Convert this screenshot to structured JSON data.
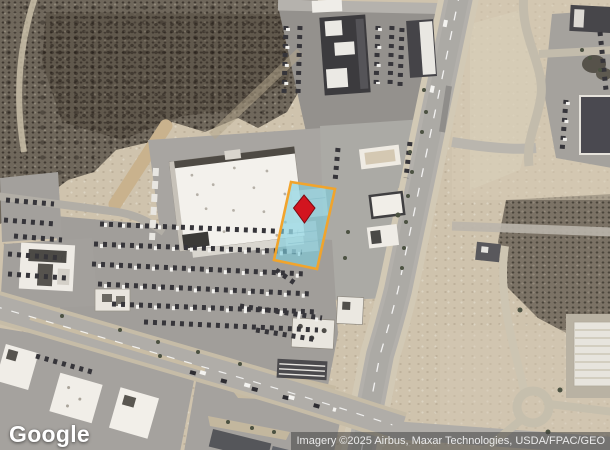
{
  "map": {
    "watermark": "Google",
    "attribution": "Imagery ©2025 Airbus, Maxar Technologies, USDA/FPAC/GEO",
    "parcel": {
      "outline_color": "#F1A42C",
      "fill_color": "rgba(124,205,221,0.62)",
      "marker": {
        "icon": "map-pin-diamond",
        "color": "#D2141F",
        "outline": "#7C0B13"
      }
    }
  }
}
